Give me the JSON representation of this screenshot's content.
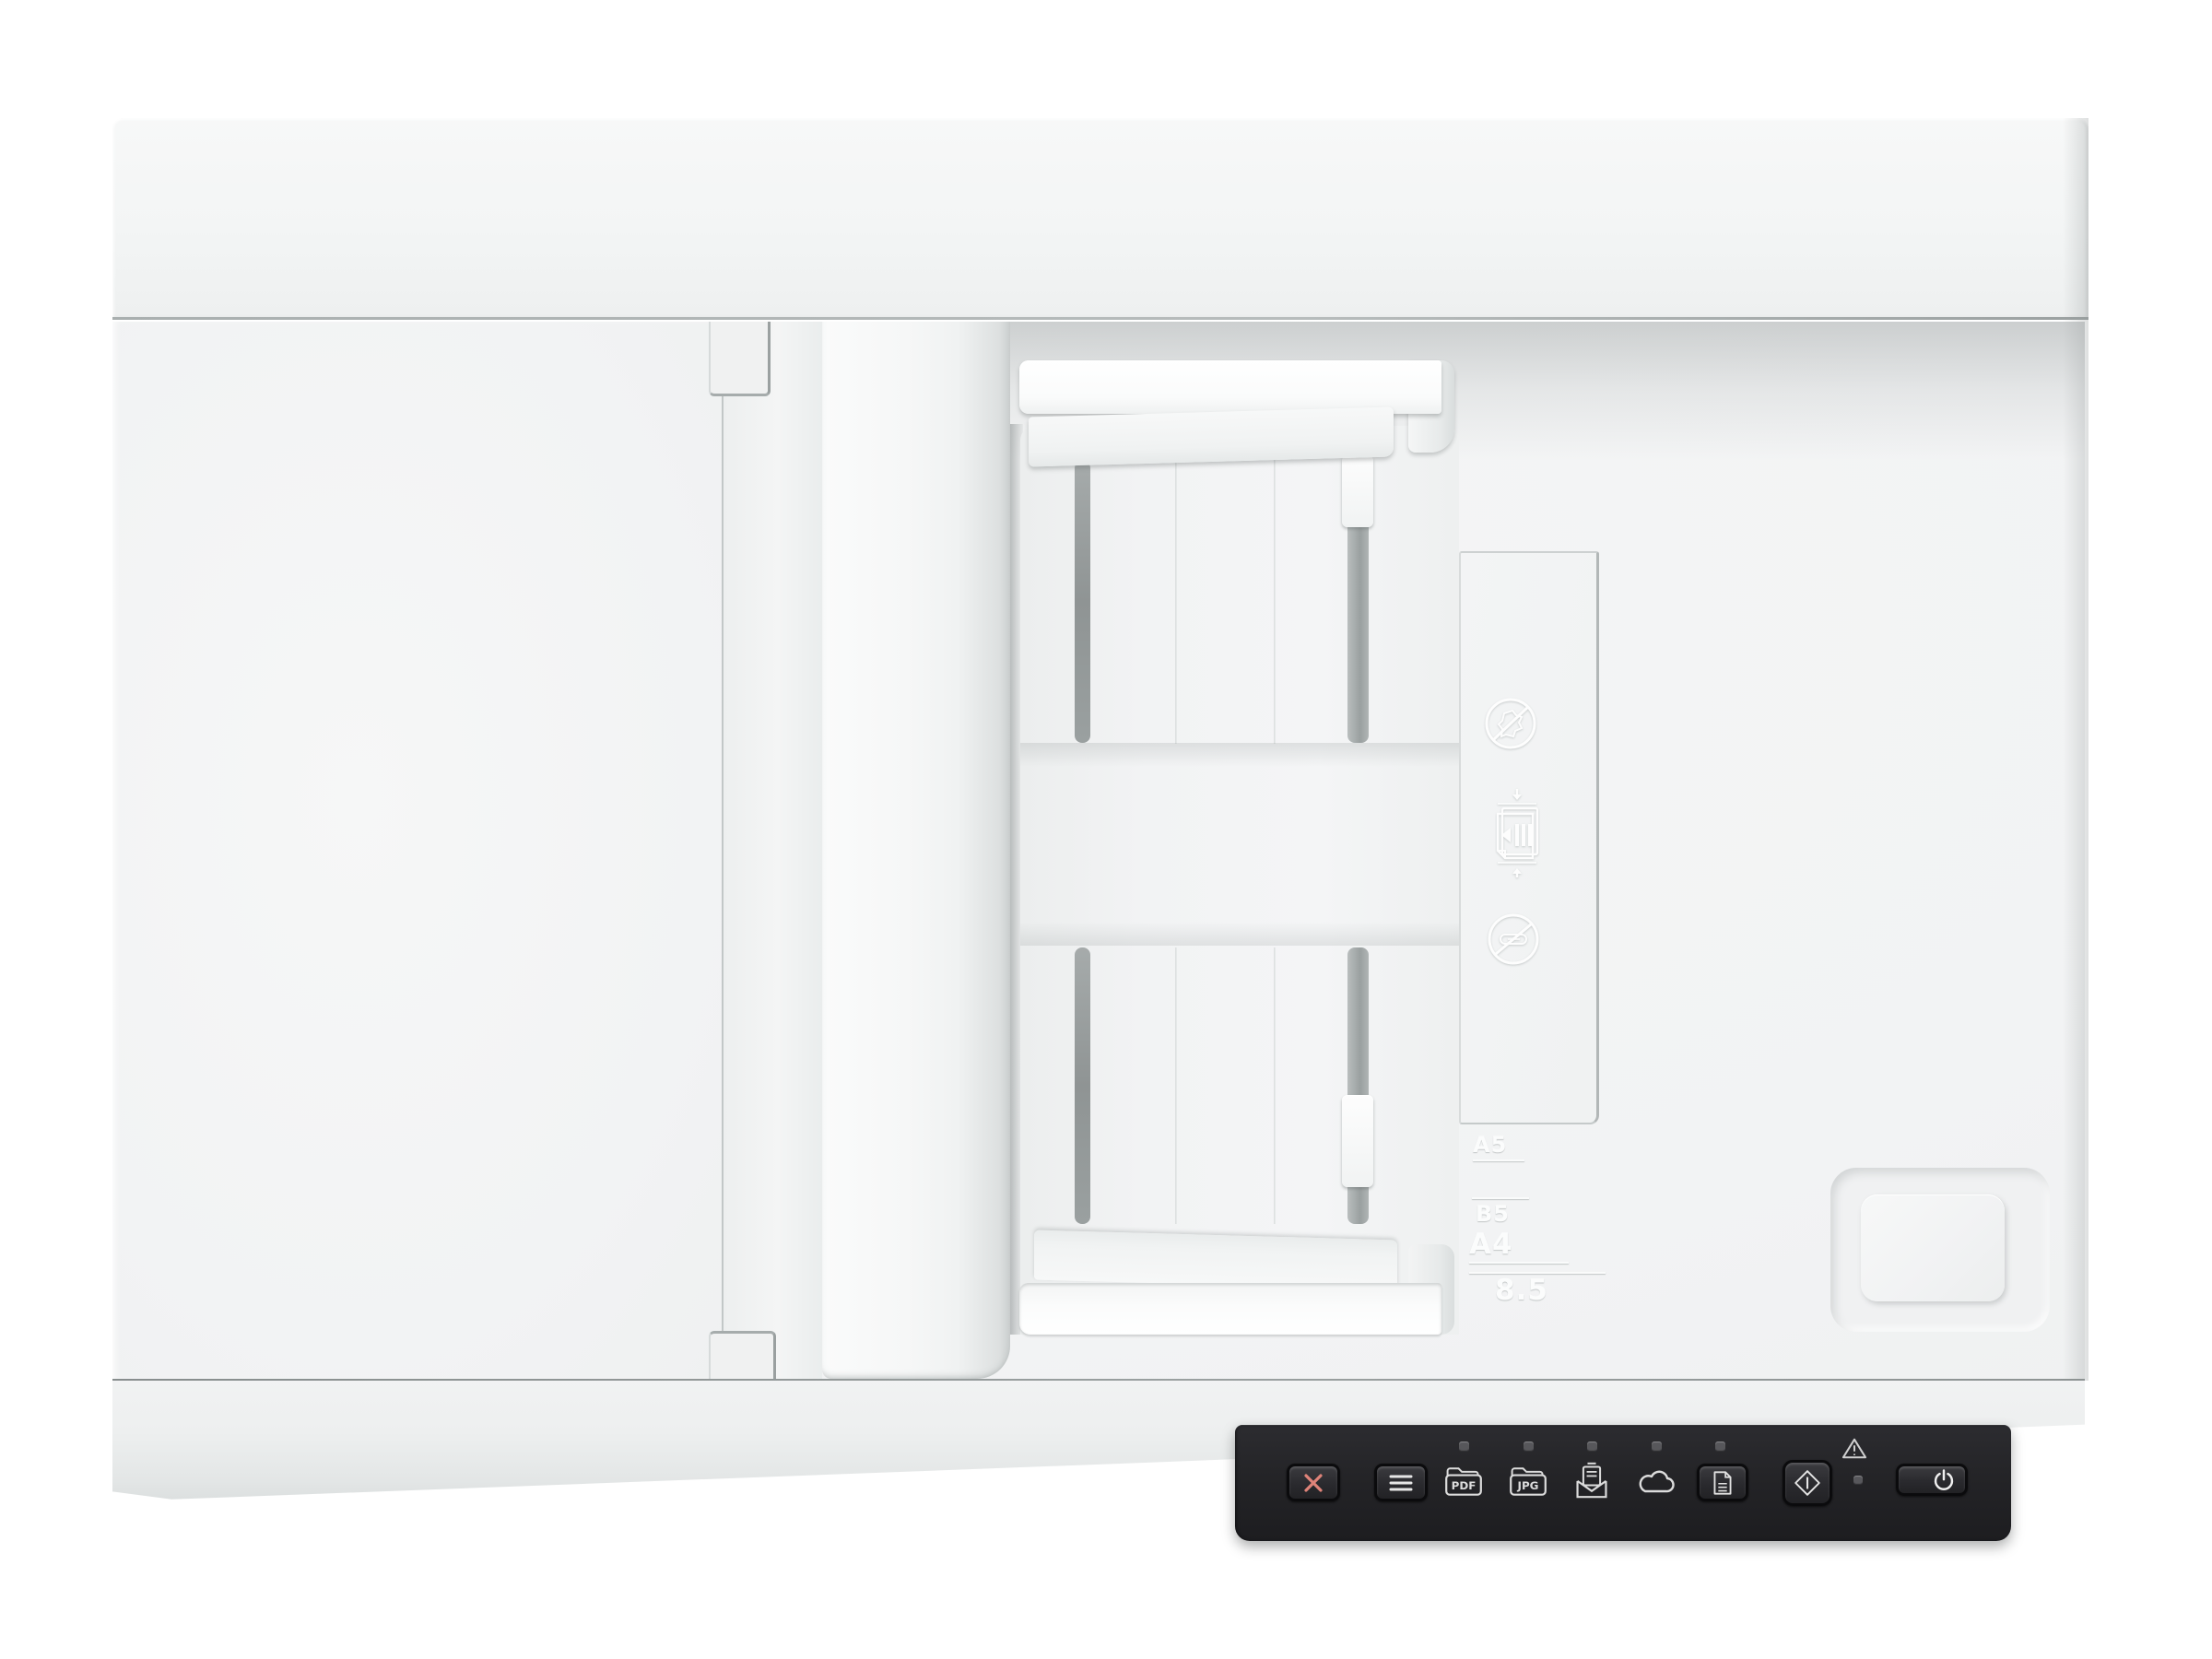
{
  "scene": {
    "description": "Top-down product view of a white flatbed document scanner with automatic document feeder and a black control panel",
    "background": "#ffffff"
  },
  "device": {
    "body_color": "#f2f3f4",
    "panel_color": "#232327",
    "accent_red": "#dd8278",
    "glyph_color": "#e2e2e2",
    "slot_color": "#8f9494"
  },
  "adf": {
    "label_icons": [
      "no-crumpled-paper-icon",
      "load-paper-stack-icon",
      "no-paperclips-icon"
    ]
  },
  "body_markings": {
    "a5": "A5",
    "b5": "B5",
    "a4": "A4",
    "letter_width": "8.5"
  },
  "control_panel": {
    "pdf_label": "PDF",
    "jpg_label": "JPG",
    "buttons": [
      {
        "id": "cancel",
        "icon": "x-cancel-icon"
      },
      {
        "id": "menu",
        "icon": "menu-lines-icon"
      },
      {
        "id": "scan-to-pdf",
        "icon": "folder-pdf-icon",
        "led": true
      },
      {
        "id": "scan-to-jpg",
        "icon": "folder-jpg-icon",
        "led": true
      },
      {
        "id": "scan-to-email",
        "icon": "email-envelope-icon",
        "led": true
      },
      {
        "id": "scan-to-cloud",
        "icon": "cloud-icon",
        "led": true
      },
      {
        "id": "scan-document",
        "icon": "document-icon",
        "led": true
      },
      {
        "id": "start-scan",
        "icon": "start-diamond-icon"
      },
      {
        "id": "power",
        "icon": "power-icon"
      }
    ],
    "indicators": [
      {
        "id": "warning",
        "icon": "warning-triangle-icon",
        "led": true
      }
    ]
  }
}
